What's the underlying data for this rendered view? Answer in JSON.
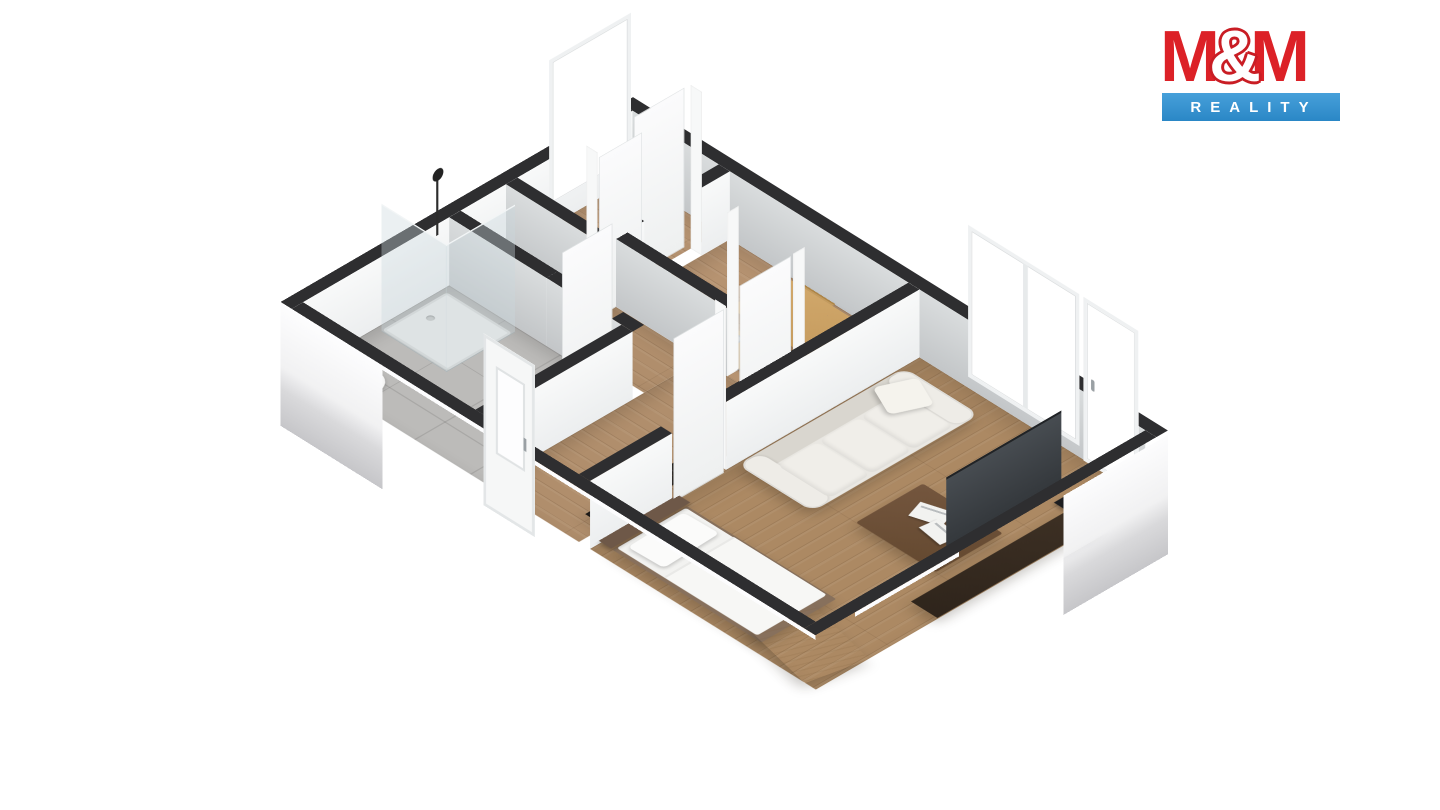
{
  "brand": {
    "m_left": "M",
    "ampersand": "&",
    "m_right": "M",
    "subtitle": "REALITY",
    "brand_red": "#dc2127",
    "brand_blue": "#2f93d4",
    "text_white": "#ffffff"
  },
  "palette": {
    "wall_cut_top": "#2e2e30",
    "wall_interior_shaded": "#cdd0d2",
    "wall_interior_bright": "#f4f5f5",
    "wall_exterior": "#fbfbfd",
    "floor_wood_kitchen": "#b69371",
    "floor_wood_hall": "#b08e6c",
    "floor_wood_living": "#ac8963",
    "floor_tile": "#bcbbb9",
    "sofa_ivory": "#e9e7e2",
    "coffee_table_walnut": "#6b4e38",
    "tv_stand_espresso": "#362a20",
    "bed_frame": "#87705c",
    "chest_beech": "#d8c39e",
    "dining_oak": "#cda566",
    "background": "#ffffff"
  },
  "floorplan": {
    "type": "3d-isometric-apartment-render",
    "rooms": [
      {
        "name": "entry vestibule",
        "floor": "wood",
        "features": [
          "tall window in NW wall",
          "open white door"
        ]
      },
      {
        "name": "kitchen / dining",
        "floor": "wood",
        "features": [
          "counter with sink and cooktop",
          "dining table",
          "2 chairs"
        ]
      },
      {
        "name": "wc",
        "floor": "tile",
        "features": [
          "toilet"
        ]
      },
      {
        "name": "bathroom",
        "floor": "tile",
        "features": [
          "corner shower with glass walls",
          "shower head",
          "floor basin"
        ]
      },
      {
        "name": "hallway",
        "floor": "wood",
        "features": [
          "black metal console shelf",
          "entrance door in SW wall"
        ]
      },
      {
        "name": "living room / bedroom",
        "floor": "wood",
        "features": [
          "3-seat sofa",
          "coffee table with magazines",
          "TV on media stand",
          "double window",
          "balcony door",
          "single bed",
          "wooden chest"
        ]
      }
    ]
  }
}
